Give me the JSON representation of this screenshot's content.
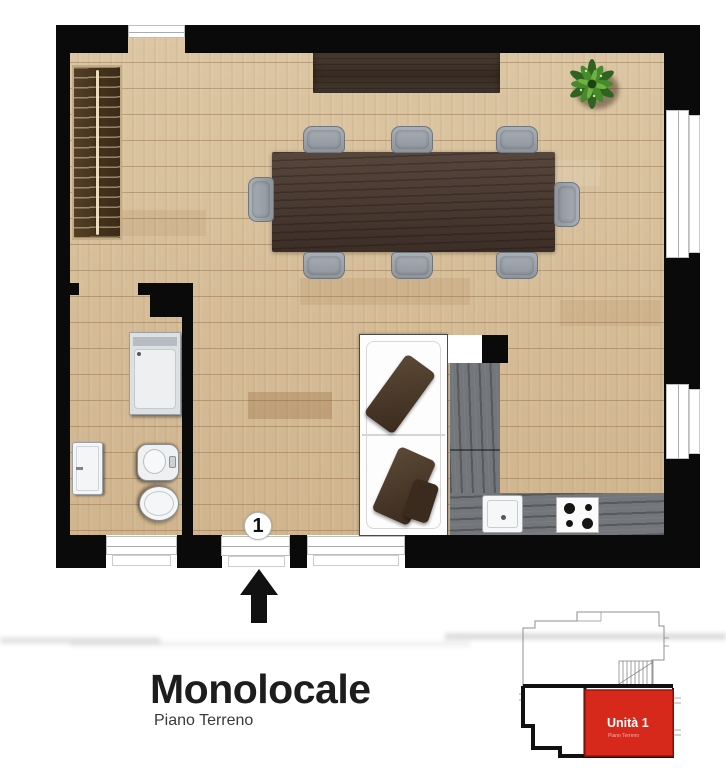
{
  "labels": {
    "title": "Monolocale",
    "subtitle": "Piano Terreno"
  },
  "plan": {
    "entrance_marker": "1"
  },
  "minimap": {
    "unit_label": "Unità 1",
    "unit_sublabel": "Piano Terreno"
  },
  "colors": {
    "wall": "#0a0a0a",
    "floor": "#d5bc96",
    "window-frame": "#ababab",
    "table": "#4a3931",
    "wardrobe": "#46341f",
    "wardrobe-frame": "#c0ab83",
    "chair": "#9ba1a9",
    "chair-border": "#70767e",
    "sofa": "#fdfdfd",
    "cushion": "#4f3d2c",
    "counter": "#73767a",
    "fixture": "#f3f5f6",
    "fixture-border": "#9aa0a5",
    "plant": "#3f7d27",
    "unit-red": "#d7281c",
    "unit-red-border": "#9c1509",
    "title": "#1d1d1d",
    "subtitle": "#3a3a3a"
  }
}
